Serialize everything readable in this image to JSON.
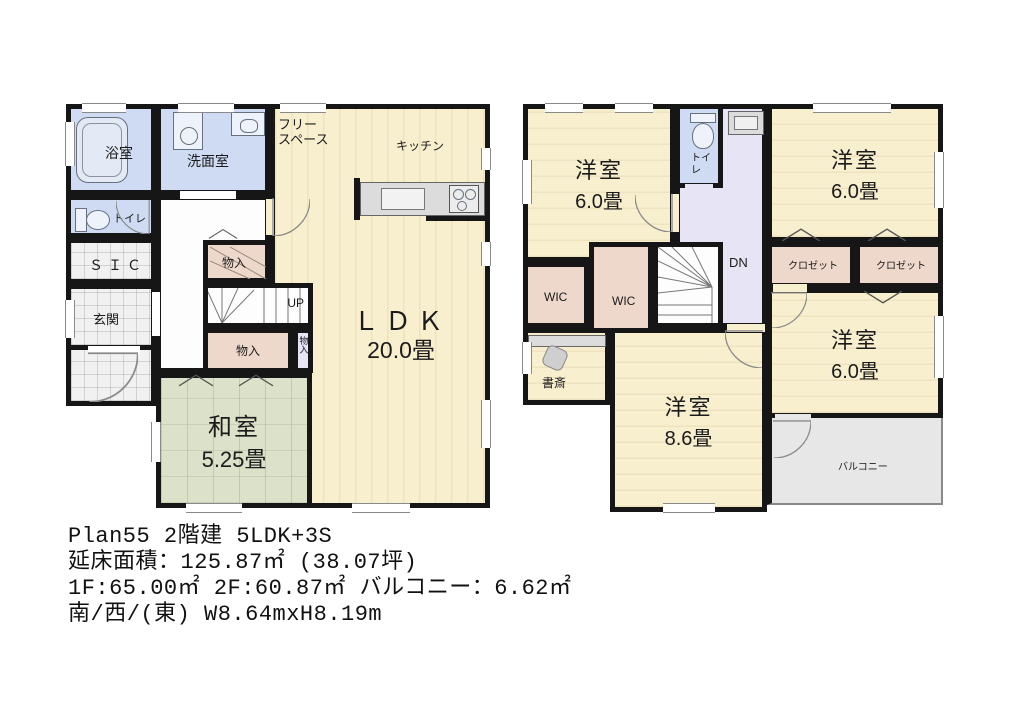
{
  "caption": {
    "line1": "Plan55 2階建 5LDK+3S",
    "line2": "延床面積：125.87㎡ (38.07坪)",
    "line3": "1F:65.00㎡ 2F:60.87㎡ バルコニー：6.62㎡",
    "line4": "南/西/(東) W8.64mxH8.19m"
  },
  "f1": {
    "bath": "浴室",
    "washroom": "洗面室",
    "toilet": "トイレ",
    "sic": "ＳＩＣ",
    "genkan": "玄関",
    "free_space": "フリー\nスペース",
    "kitchen": "キッチン",
    "ldk_name": "ＬＤＫ",
    "ldk_size": "20.0畳",
    "washitsu_name": "和室",
    "washitsu_size": "5.25畳",
    "storage_a": "物入",
    "storage_b": "物入",
    "storage_c": "物入",
    "up": "UP"
  },
  "f2": {
    "bed1_name": "洋室",
    "bed1_size": "6.0畳",
    "bed2_name": "洋室",
    "bed2_size": "6.0畳",
    "bed3_name": "洋室",
    "bed3_size": "6.0畳",
    "bed4_name": "洋室",
    "bed4_size": "8.6畳",
    "toilet": "トイレ",
    "wic1": "WIC",
    "wic2": "WIC",
    "closet1": "クロゼット",
    "closet2": "クロゼット",
    "study": "書斎",
    "balcony": "バルコニー",
    "dn": "DN"
  },
  "colors": {
    "wall": "#161616",
    "wood": "#f8efcf",
    "tatami": "#dce1ca",
    "wet": "#cedbf2",
    "closet": "#eed8cb",
    "hall2f": "#e7e4f5",
    "tile": "#f1f1f1",
    "balcony": "#e7e7e7"
  }
}
